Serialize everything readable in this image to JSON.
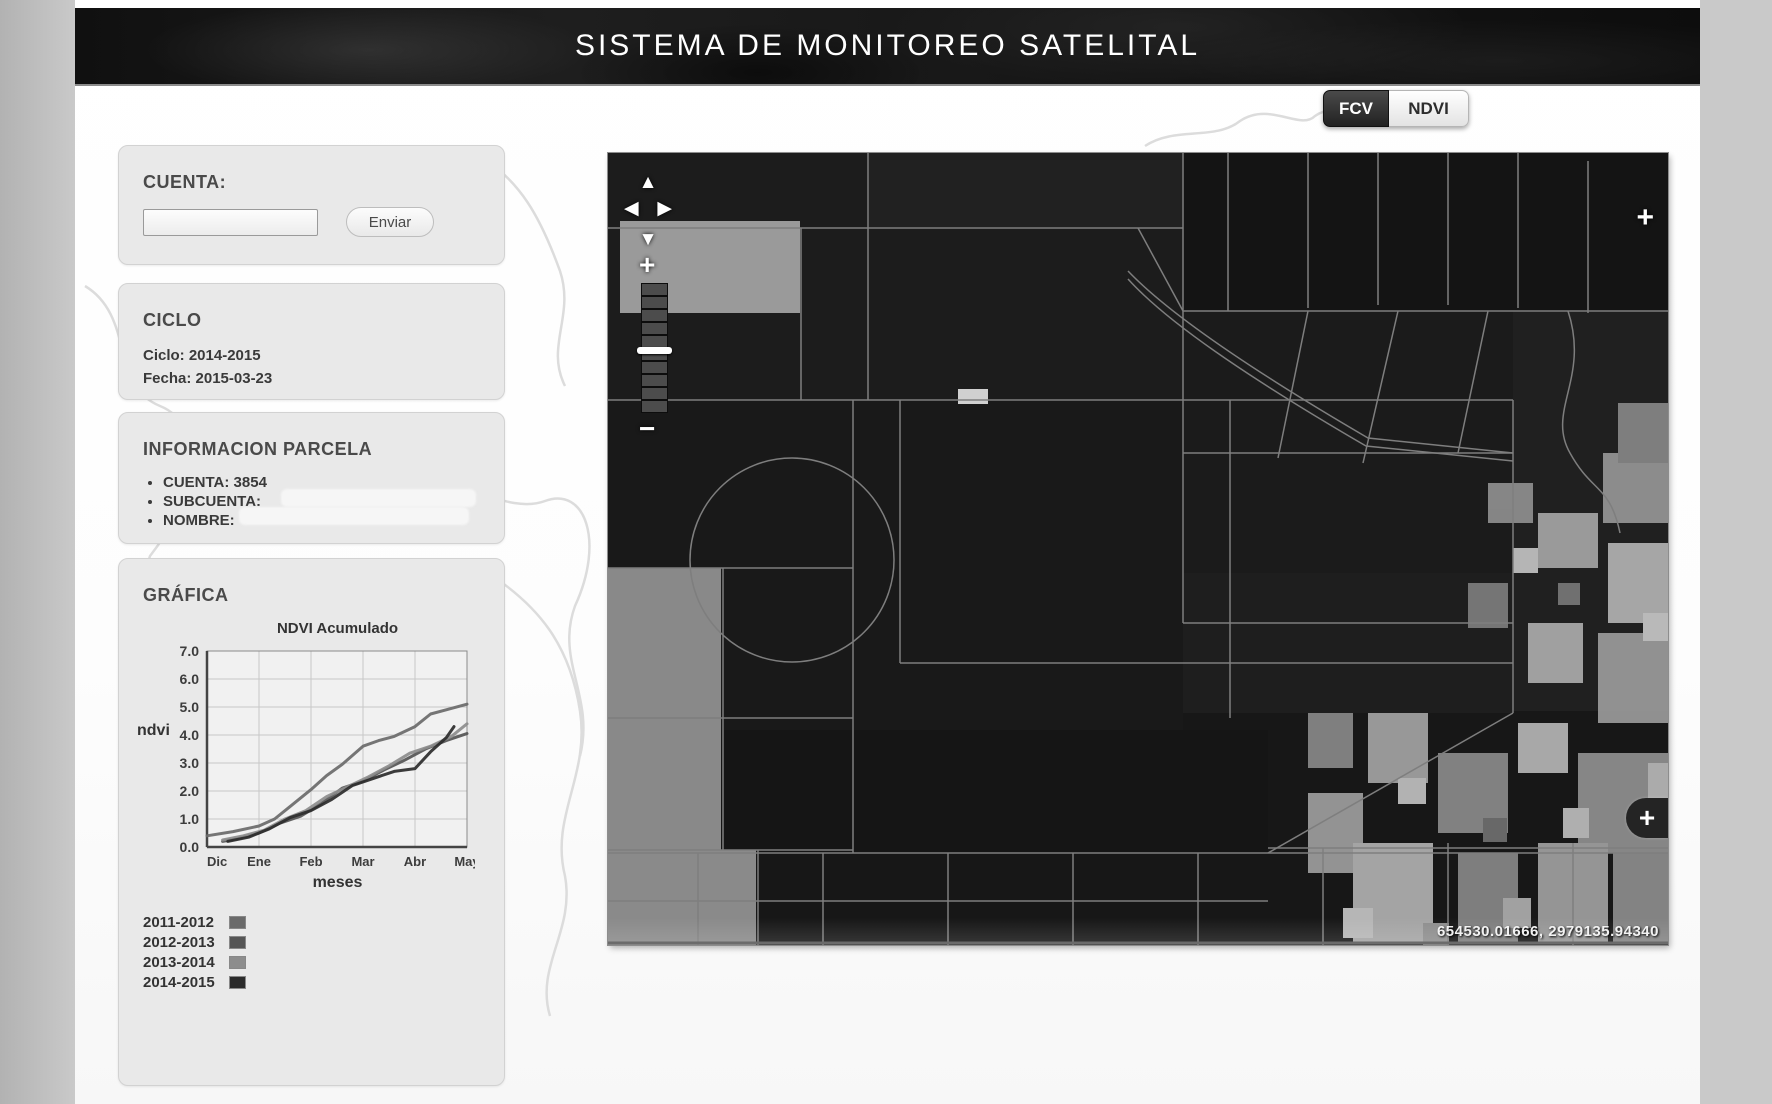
{
  "header": {
    "title": "SISTEMA DE MONITOREO SATELITAL"
  },
  "view_toggle": {
    "fcv_label": "FCV",
    "ndvi_label": "NDVI",
    "active": "FCV"
  },
  "sidebar": {
    "cuenta_panel": {
      "label": "CUENTA:",
      "input_value": "",
      "submit_label": "Enviar"
    },
    "ciclo_panel": {
      "title": "CICLO",
      "ciclo_line": "Ciclo: 2014-2015",
      "fecha_line": "Fecha: 2015-03-23"
    },
    "parcela_panel": {
      "title": "INFORMACION PARCELA",
      "items": [
        "CUENTA: 3854",
        "SUBCUENTA:",
        "NOMBRE:"
      ]
    },
    "grafica_panel": {
      "title": "GRÁFICA"
    }
  },
  "chart_data": {
    "type": "line",
    "title": "NDVI Acumulado",
    "xlabel": "meses",
    "ylabel": "ndvi",
    "x_ticks": [
      "Dic",
      "Ene",
      "Feb",
      "Mar",
      "Abr",
      "May"
    ],
    "ylim": [
      0,
      7
    ],
    "y_tick_step": 1,
    "grid": true,
    "legend_position": "bottom-left",
    "series": [
      {
        "name": "2011-2012",
        "color": "#6a6a6a",
        "x": [
          0,
          0.5,
          1,
          1.3,
          1.6,
          2,
          2.3,
          2.6,
          3,
          3.3,
          3.6,
          4,
          4.3,
          4.6,
          5
        ],
        "y": [
          0.4,
          0.55,
          0.75,
          1.0,
          1.45,
          2.05,
          2.55,
          2.95,
          3.6,
          3.8,
          3.95,
          4.3,
          4.75,
          4.9,
          5.1
        ]
      },
      {
        "name": "2012-2013",
        "color": "#555555",
        "x": [
          0.3,
          0.6,
          1,
          1.4,
          1.8,
          2.2,
          2.6,
          3,
          3.4,
          3.8,
          4.2,
          4.6,
          5
        ],
        "y": [
          0.2,
          0.3,
          0.5,
          0.85,
          1.1,
          1.55,
          2.1,
          2.35,
          2.75,
          3.1,
          3.5,
          3.8,
          4.05
        ]
      },
      {
        "name": "2013-2014",
        "color": "#8d8d8d",
        "x": [
          0.3,
          0.7,
          1.1,
          1.5,
          1.9,
          2.3,
          2.7,
          3.1,
          3.5,
          3.9,
          4.3,
          4.7,
          5
        ],
        "y": [
          0.25,
          0.4,
          0.6,
          1.0,
          1.3,
          1.8,
          2.15,
          2.5,
          2.9,
          3.35,
          3.6,
          3.95,
          4.4
        ]
      },
      {
        "name": "2014-2015",
        "color": "#2b2b2b",
        "x": [
          0.4,
          0.8,
          1.2,
          1.6,
          2.0,
          2.4,
          2.8,
          3.2,
          3.6,
          4.0,
          4.3,
          4.6,
          4.75
        ],
        "y": [
          0.2,
          0.35,
          0.65,
          1.05,
          1.3,
          1.7,
          2.2,
          2.45,
          2.7,
          2.8,
          3.4,
          3.9,
          4.3
        ]
      }
    ]
  },
  "map": {
    "coordinates_readout": "654530.01666, 2979135.94340",
    "icons": {
      "pan_up": "▲",
      "pan_left": "◀",
      "pan_right": "▶",
      "pan_down": "▼",
      "zoom_in": "+",
      "zoom_out": "−",
      "expand": "+"
    }
  }
}
